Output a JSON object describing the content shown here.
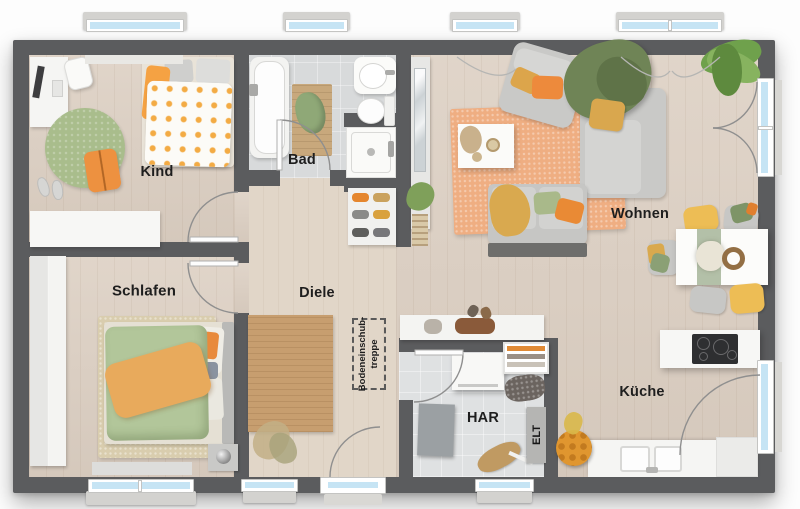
{
  "rooms": {
    "kind": {
      "label": "Kind"
    },
    "bad": {
      "label": "Bad"
    },
    "wohnen": {
      "label": "Wohnen"
    },
    "schlafen": {
      "label": "Schlafen"
    },
    "diele": {
      "label": "Diele"
    },
    "har": {
      "label": "HAR"
    },
    "kueche": {
      "label": "Küche"
    }
  },
  "annotations": {
    "elt": {
      "label": "ELT"
    },
    "attic_stairs": {
      "line1": "Bodeneinschub-",
      "line2": "treppe"
    }
  },
  "colors": {
    "wall": "#5b5c5e",
    "wood_floor": "#dccfc2",
    "hall_floor": "#e1d6c8",
    "tile_floor": "#d8dadb",
    "window_glass": "#c6e4f4",
    "rug_wohnen": "#efae82",
    "rug_kind": "#a9bd8c",
    "rug_diele": "#c79e6f",
    "rug_schlafen": "#d9cdae",
    "accent_orange": "#ed8a3c",
    "accent_mustard": "#d9a94e",
    "accent_green": "#8fa877",
    "chair_yellow": "#edbd55",
    "sofa_gray": "#c9c9c7"
  },
  "fixtures": {
    "kind": [
      "desk",
      "desk-chair",
      "bed",
      "round-rug",
      "floor-pillow",
      "slippers",
      "sideboard"
    ],
    "bad": [
      "bathtub",
      "bath-mat",
      "towel",
      "washbasin",
      "toilet",
      "shower"
    ],
    "wohnen": [
      "rug",
      "armchair",
      "sofa",
      "blanket",
      "coffee-table",
      "loveseat",
      "palm-plant",
      "dining-table",
      "chairs"
    ],
    "schlafen": [
      "wardrobe",
      "rug",
      "double-bed",
      "nightstand",
      "lamp"
    ],
    "diele": [
      "runner-rug",
      "dried-plant",
      "shoe-rack",
      "mirror-sideboard",
      "bench"
    ],
    "har": [
      "washing-machine",
      "drying-rack",
      "laundry-basket",
      "storage-box",
      "ironing-board",
      "elt-panel"
    ],
    "kueche": [
      "island-cooktop",
      "sink-counter",
      "tall-unit",
      "fruit-basket"
    ]
  }
}
